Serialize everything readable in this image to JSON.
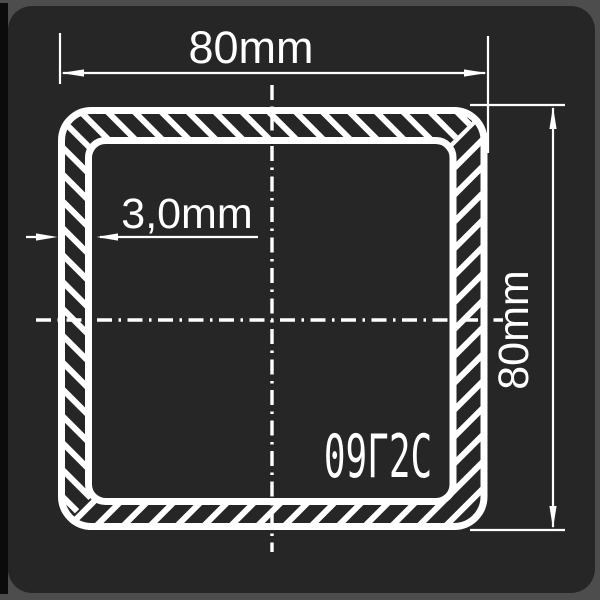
{
  "frame": {
    "outer_bg": "#4d4d4d",
    "left_edge_bg": "#0b0b0b",
    "panel_bg": "#262626"
  },
  "diagram": {
    "description": "square tube cross-section technical drawing",
    "line_color": "#ffffff",
    "width_dim": {
      "label": "80mm"
    },
    "height_dim": {
      "label": "80mm"
    },
    "thickness_dim": {
      "label": "3,0mm"
    },
    "steel_grade": "09Г2С"
  }
}
